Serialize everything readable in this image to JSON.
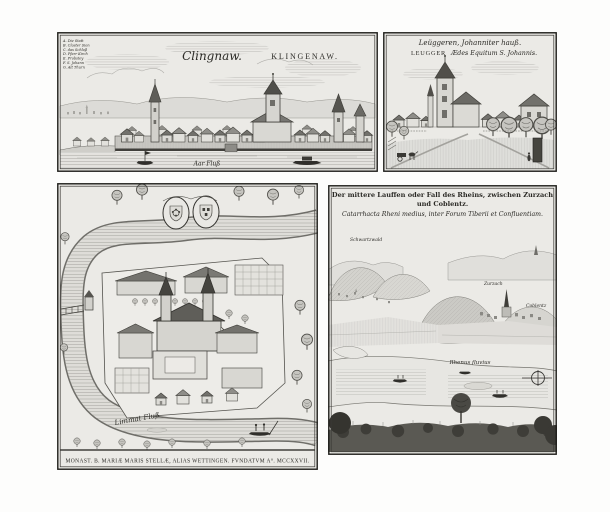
{
  "colors": {
    "page_background": "#fdfdfc",
    "paper": "#ebeae6",
    "ink": "#2b2a26",
    "hatch_gray": "#8f8e89"
  },
  "panels": {
    "klingnau": {
      "title_script": "Clingnaw.",
      "title_caps": "KLINGENAW.",
      "legend": [
        "A. Die Statt",
        "B. Closter Sion",
        "C. das Schloß",
        "D. Pfarr Kirch",
        "E. Probstey",
        "F. S. Johann",
        "G. Alt Thurn"
      ],
      "river_label": "Aar Fluß"
    },
    "leuggern": {
      "title_german": "Leüggeren, Johanniter hauß.",
      "title_latin_name": "LEUGGER",
      "title_latin_rest": "Ædes Equitum S. Johannis."
    },
    "wettingen": {
      "river_label": "Limmat Fluß",
      "caption": "MONAST. B. MARIÆ MARIS STELLÆ, ALIAS WETTINGEN. FVNDATVM A°. MCCXXVII."
    },
    "rhine_fall": {
      "title_line1": "Der mittere Lauffen oder Fall des Rheins, zwischen Zurzach",
      "title_line2": "und Coblentz.",
      "title_latin": "Catarrhacta Rheni medius, inter Forum Tiberii et Confluentiam.",
      "label_forest": "Schwartzwald",
      "label_town": "Zurzach",
      "label_right": "Coblentz",
      "river_label": "Rhenus fluvius"
    }
  }
}
